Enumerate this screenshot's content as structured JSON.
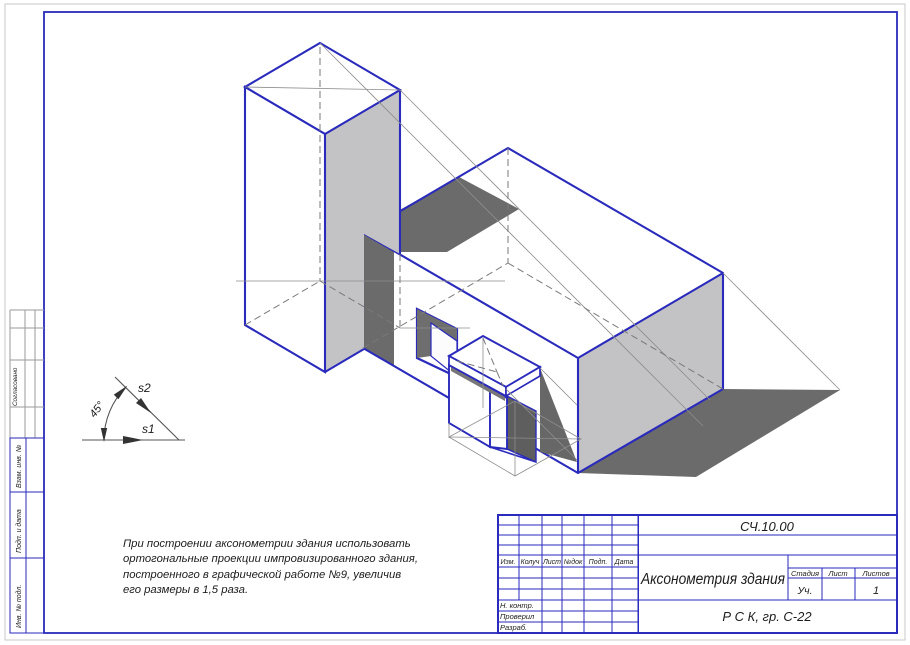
{
  "colors": {
    "blue": "#2a2abc",
    "face_gray": "#c3c3c5",
    "shadow_dark": "#6b6b6b",
    "construction_gray": "#8d8d8d",
    "page_border_gray": "#c8c8c8"
  },
  "legend": {
    "s1": "s1",
    "s2": "s2",
    "angle": "45°"
  },
  "note": {
    "lines": [
      "При построении аксонометрии здания использовать",
      "ортогональные проекции импровизированного здания,",
      "построенного в графической работе №9, увеличив",
      "его размеры в 1,5 раза."
    ]
  },
  "margin": {
    "labels": [
      "Согласовано",
      "Взам. инв. №",
      "Подп. и дата",
      "Инв. № подл."
    ]
  },
  "stamp": {
    "code": "СЧ.10.00",
    "title": "Аксонометрия здания",
    "cols": [
      "Изм.",
      "Колуч",
      "Лист",
      "№док",
      "Подп.",
      "Дата"
    ],
    "rows": [
      "Н. контр.",
      "Проверил",
      "Разраб."
    ],
    "stage": {
      "headers": [
        "Стадия",
        "Лист",
        "Листов"
      ],
      "stage_value": "Уч.",
      "sheet_value": "",
      "sheets_value": "1"
    },
    "org": "Р С К, гр. С-22"
  }
}
